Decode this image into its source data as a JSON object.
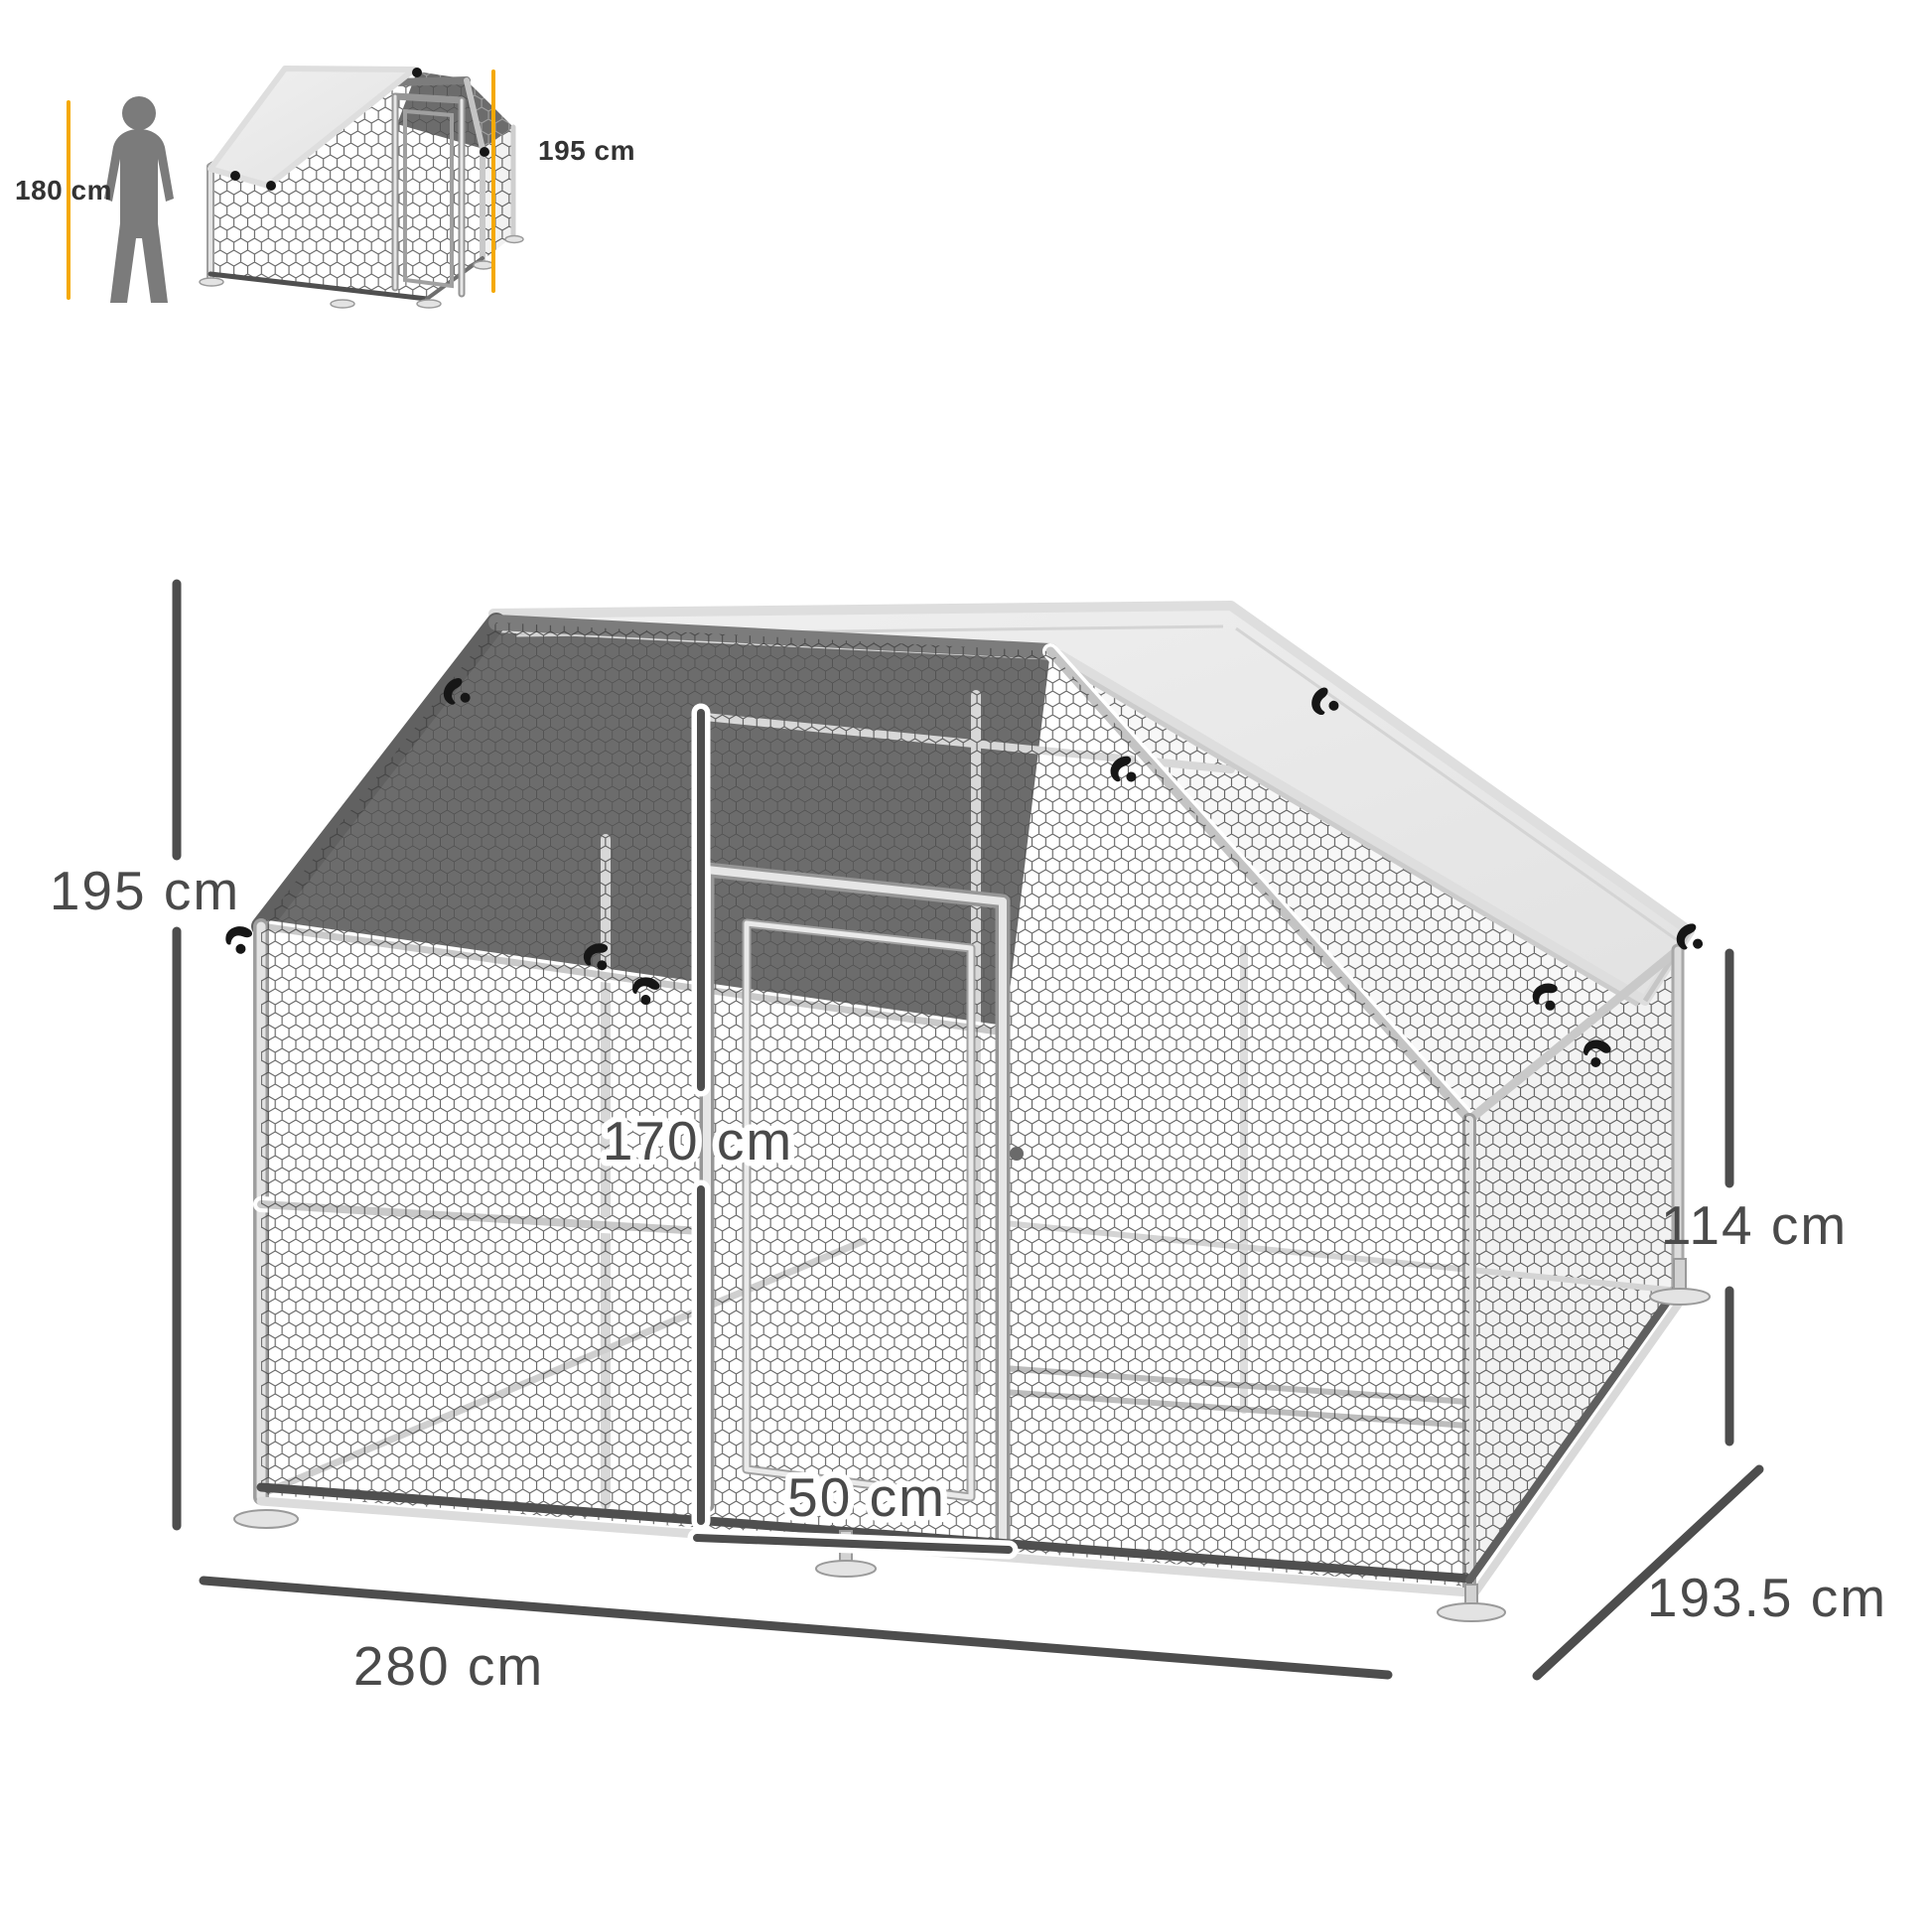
{
  "inset": {
    "person_height_label": "180 cm",
    "cage_height_label": "195 cm"
  },
  "dimensions": {
    "total_height": "195 cm",
    "door_height": "170 cm",
    "door_width": "50 cm",
    "width": "280 cm",
    "depth": "193.5 cm",
    "side_wall_height": "114 cm"
  },
  "colors": {
    "accent": "#F5A900",
    "dimension_line": "#4D4D4D",
    "roof_cover": "#E8E8E8",
    "dark_mesh": "#6C6C6C"
  },
  "icons": {
    "person": "person-silhouette-icon"
  }
}
